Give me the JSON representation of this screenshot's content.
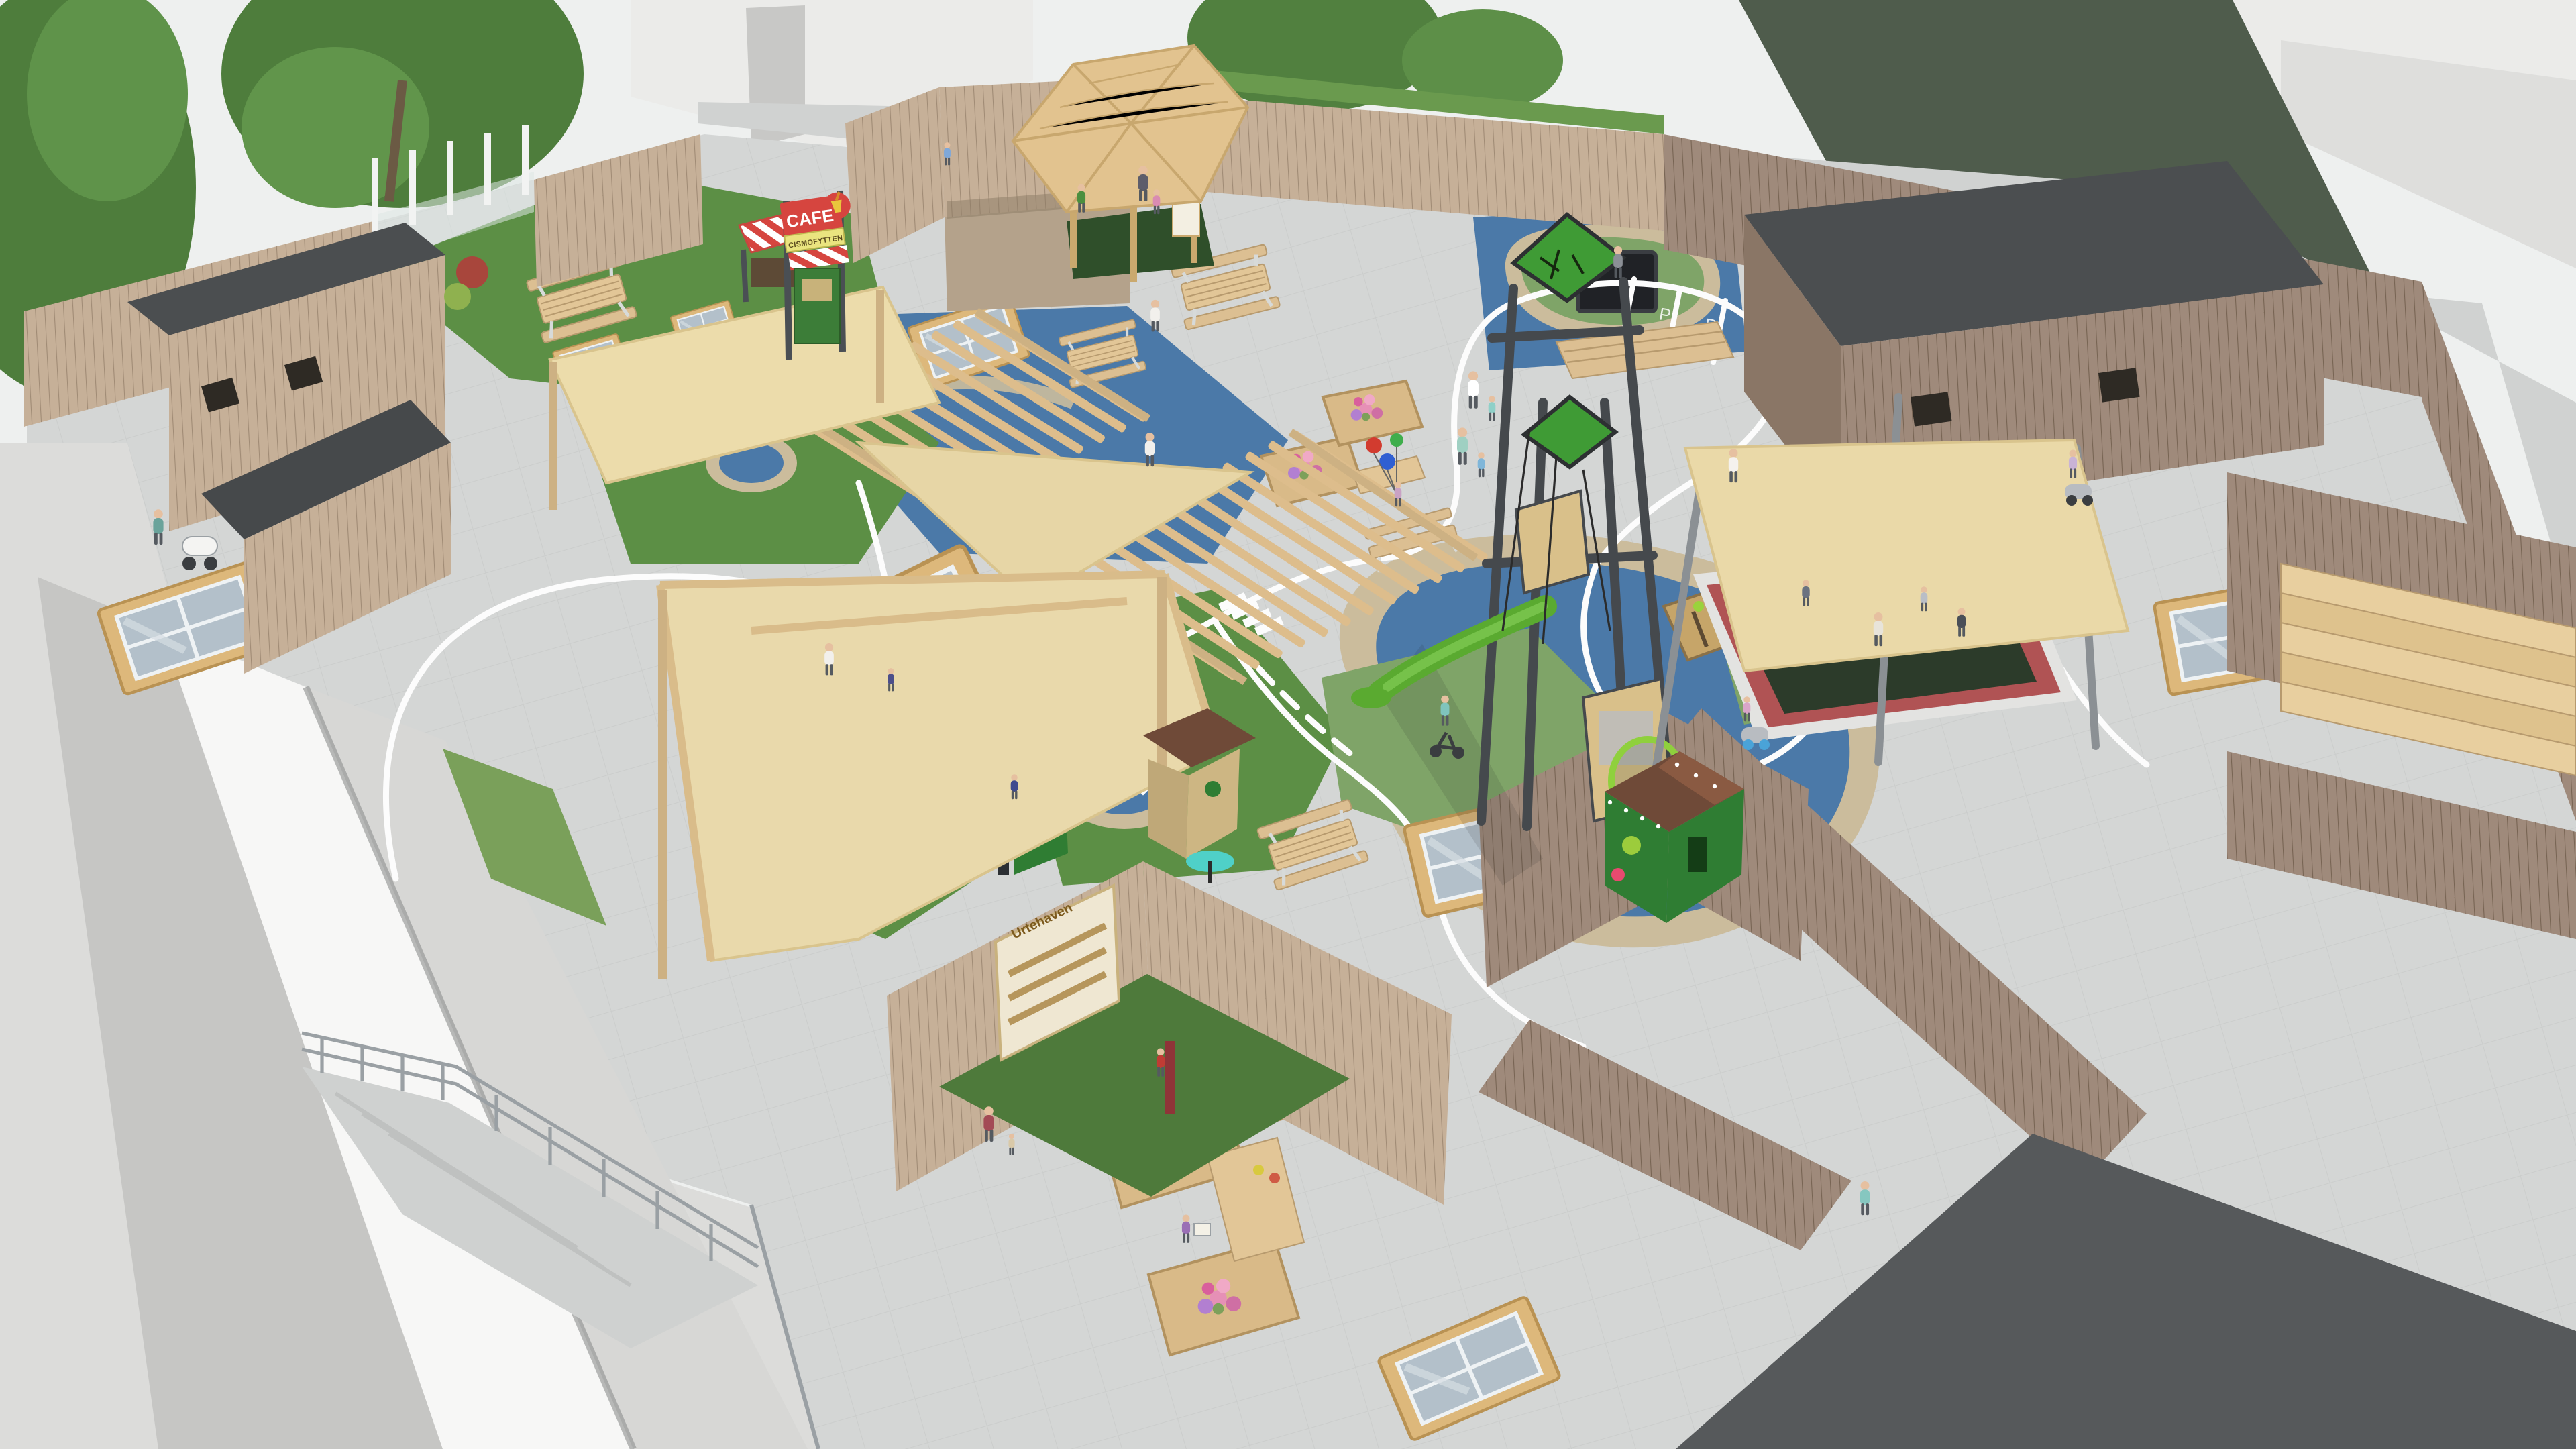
{
  "scene": {
    "kind": "3d-architectural-rendering",
    "subject": "aerial-view-rooftop-kindergarten-playground",
    "signs": {
      "cafe": {
        "line1": "CAFE",
        "line2": "CISMOFYTTEN"
      },
      "herb_garden": {
        "label": "Urtehaven"
      },
      "parking": {
        "letter": "P"
      }
    },
    "palette": {
      "pavement": "#d4d6d5",
      "pavement_tile_line": "#c3c5c4",
      "wood_fence_light": "#c6b098",
      "wood_fence_dark": "#9f8a7b",
      "wood_beam": "#d9bc8a",
      "canopy_sail": "#e9d9ab",
      "lawn_green": "#5c8f45",
      "rubber_blue": "#4b79a8",
      "rubber_green": "#7fa468",
      "rubber_tan": "#cbbc9c",
      "slide_green": "#5aaa30",
      "panel_green": "#3f9b35",
      "tower_frame_gray": "#45494d",
      "roof_dark": "#4b4e50",
      "sandpit_red": "#b05354",
      "cafe_red": "#d6453f",
      "cafe_yellow": "#eae47f",
      "skylight_glass": "#b3c0ca",
      "road_marking_white": "#fcfcfc",
      "building_green": "#4f5c4c",
      "building_white": "#ebebe9"
    },
    "objects": [
      "rooftop-terrace",
      "perimeter-wood-fence",
      "storage-shed",
      "trash-enclosure",
      "cafe-play-stand",
      "striped-play-canopy",
      "glass-fence",
      "herb-garden-enclosure",
      "playground-tower",
      "slide",
      "climbing-ramp",
      "trampoline-island",
      "sandpit",
      "shade-sail",
      "pergola",
      "gazebo",
      "picnic-table",
      "flower-planter",
      "bench",
      "skylight-box",
      "road-circuit",
      "roundabout",
      "parking-bays",
      "zebra-crossing",
      "playhouse",
      "toddler-play-structure",
      "staircase",
      "pram",
      "ride-on-toy",
      "people",
      "trees",
      "surrounding-buildings",
      "amphitheater-steps",
      "lower-roof"
    ]
  }
}
